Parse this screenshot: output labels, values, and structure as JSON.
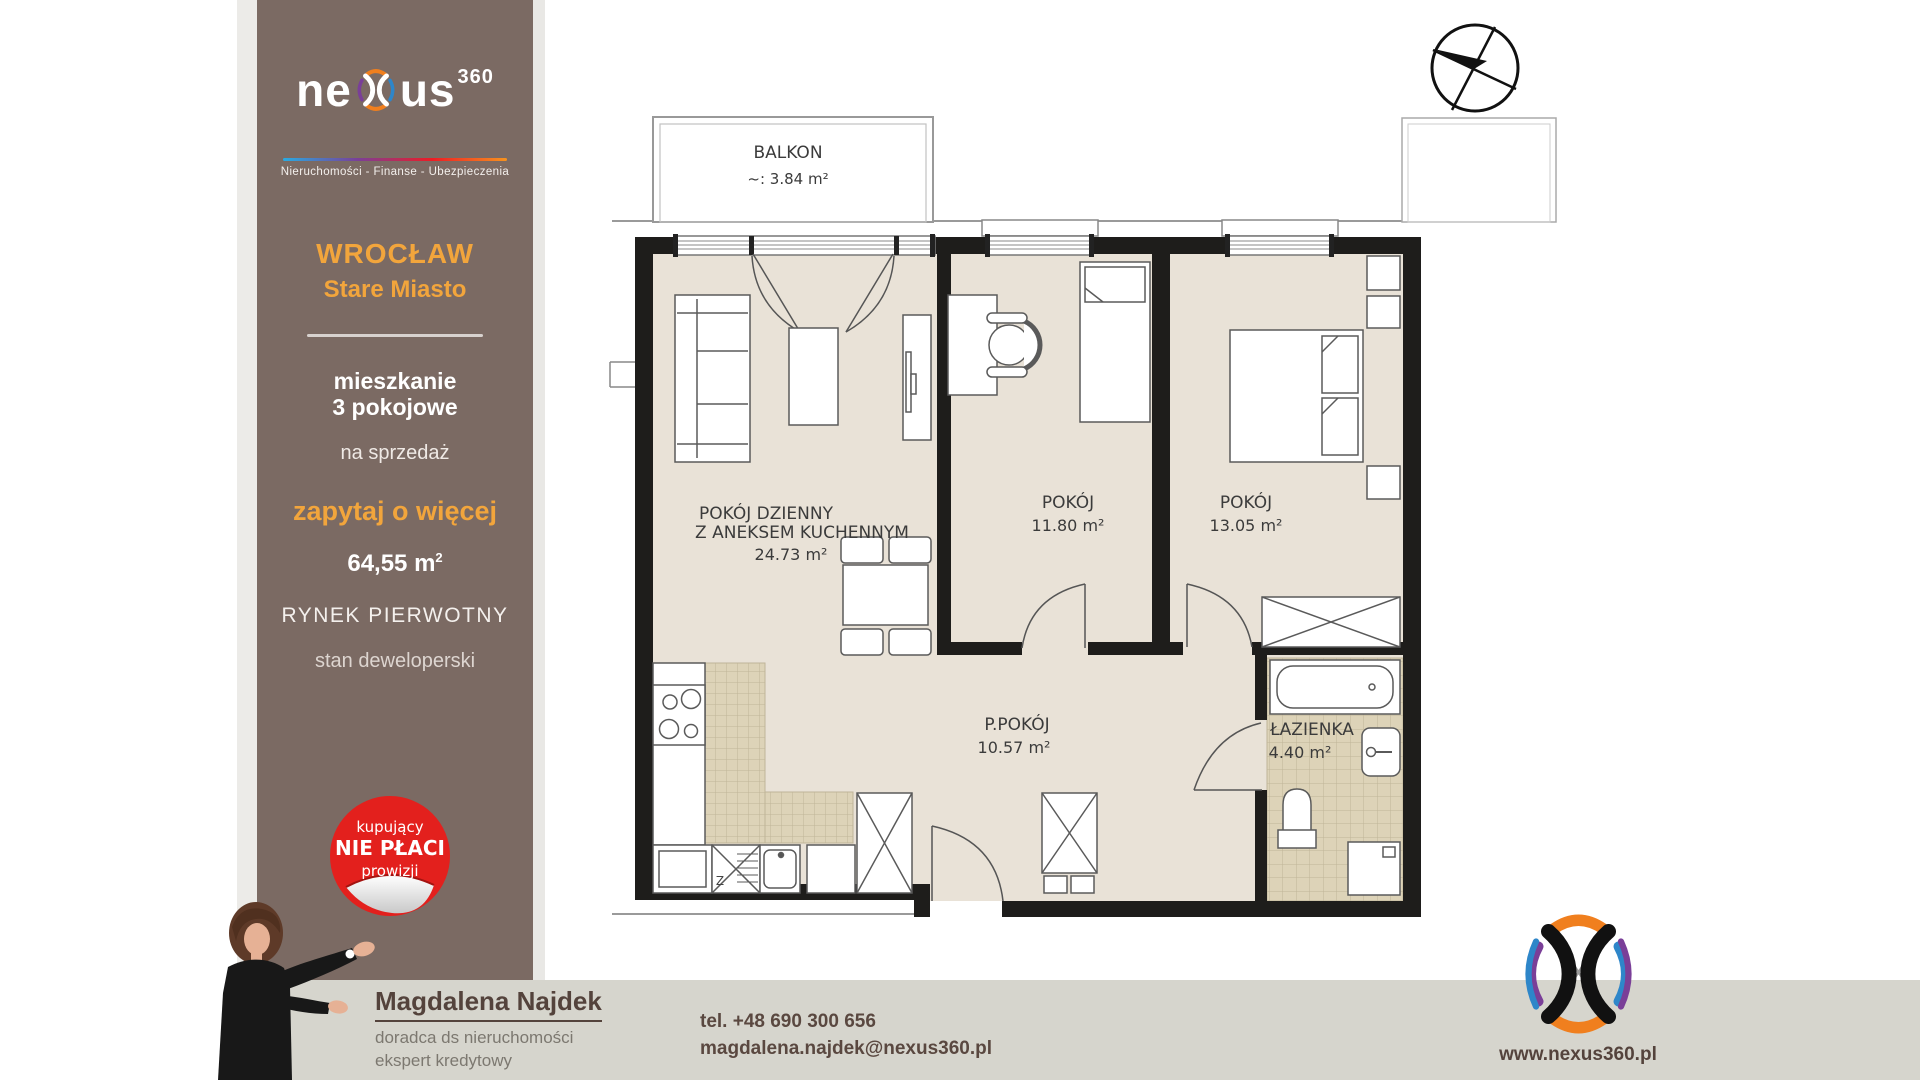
{
  "sidebar": {
    "brand": {
      "name_pre": "ne",
      "name_post": "us",
      "superscript": "360",
      "tagline": "Nieruchomości - Finanse - Ubezpieczenia"
    },
    "location": {
      "city": "WROCŁAW",
      "district": "Stare Miasto"
    },
    "listing": {
      "type_line1": "mieszkanie",
      "type_line2": "3 pokojowe",
      "offer": "na sprzedaż",
      "cta": "zapytaj o więcej",
      "area_value": "64,55 m",
      "area_sup": "2",
      "market": "RYNEK PIERWOTNY",
      "condition": "stan deweloperski"
    },
    "badge": {
      "line1": "kupujący",
      "line2": "NIE PŁACI",
      "line3": "prowizji"
    }
  },
  "floor_plan": {
    "rooms": [
      {
        "name": "BALKON",
        "area": "~:  3.84 m²"
      },
      {
        "name_line1": "POKÓJ DZIENNY",
        "name_line2": "Z ANEKSEM KUCHENNYM",
        "area": "24.73 m²"
      },
      {
        "name": "POKÓJ",
        "area": "11.80 m²"
      },
      {
        "name": "POKÓJ",
        "area": "13.05 m²"
      },
      {
        "name": "P.POKÓJ",
        "area": "10.57 m²"
      },
      {
        "name": "ŁAZIENKA",
        "area": "4.40 m²"
      }
    ],
    "kitchen_sink_mark": "Z"
  },
  "footer": {
    "agent": {
      "name": "Magdalena Najdek",
      "role1": "doradca ds nieruchomości",
      "role2": "ekspert kredytowy"
    },
    "contact": {
      "phone": "tel. +48 690 300 656",
      "email": "magdalena.najdek@nexus360.pl"
    },
    "website": "www.nexus360.pl"
  },
  "colors": {
    "sidebar_brown": "#7b6a63",
    "accent_orange": "#f2a53c",
    "badge_red": "#e3201d",
    "footer_grey": "#d6d5cd",
    "floor_beige": "#e9e2d7",
    "tile_beige": "#ddd3b8"
  }
}
